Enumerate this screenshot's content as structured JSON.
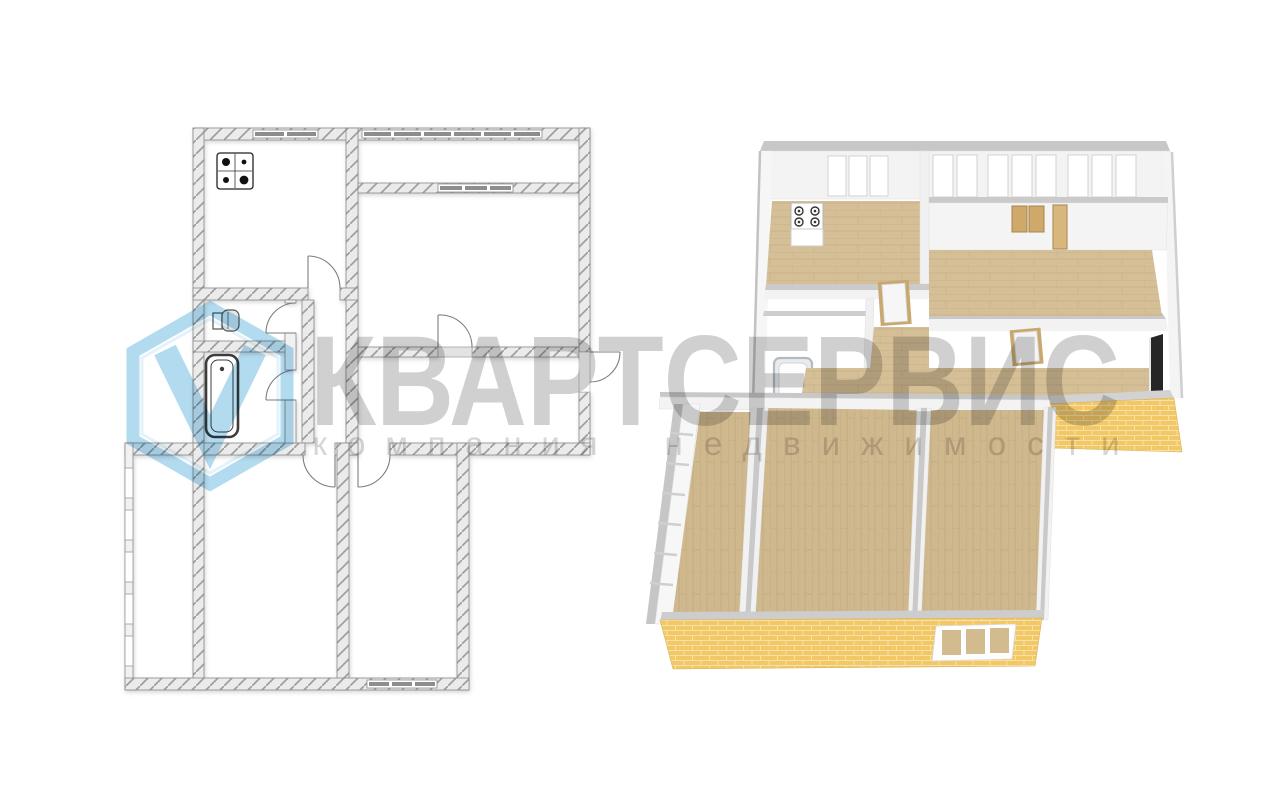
{
  "watermark": {
    "title": "КВАРТСЕРВИС",
    "subtitle_word1": "компания",
    "subtitle_word2": "недвижимости",
    "logo_icon": "hexagon-v-logo",
    "title_color": "#d0d0d0",
    "subtitle_color": "#d6d6d6",
    "logo_color": "#b3dbf0"
  },
  "plan_2d": {
    "fixtures": [
      "stove-icon",
      "toilet-icon",
      "bathtub-icon"
    ],
    "wall_fill": "#ebebeb",
    "hatch_color": "#9f9f9f",
    "window_color": "#8d8d8d",
    "line_color": "#8a8a8a"
  },
  "plan_3d": {
    "fixtures": [
      "stove-icon",
      "bathtub-icon",
      "door-panels",
      "wood-panels"
    ],
    "floor_color": "#d5bf97",
    "brick_color": "#f2c866",
    "wall_top_color": "#c8c8c8",
    "wall_face_color": "#f3f3f3"
  },
  "canvas": {
    "background": "#ffffff"
  }
}
